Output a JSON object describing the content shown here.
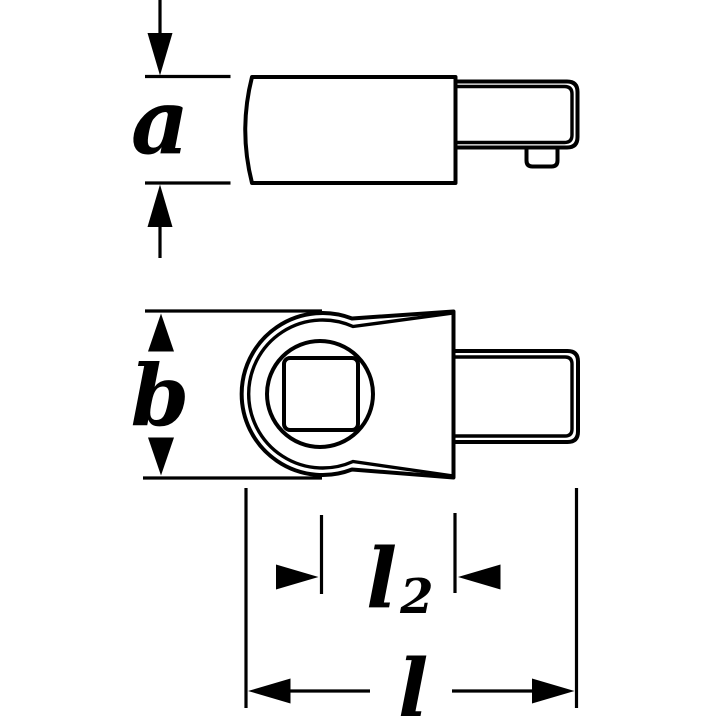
{
  "drawing": {
    "title": "insert-tool dimension drawing",
    "labels": {
      "dim_a": "a",
      "dim_b": "b",
      "dim_l2_base": "l",
      "dim_l2_sub": "2",
      "dim_l": "l"
    },
    "colors": {
      "ink": "#000000",
      "background": "#ffffff"
    }
  }
}
